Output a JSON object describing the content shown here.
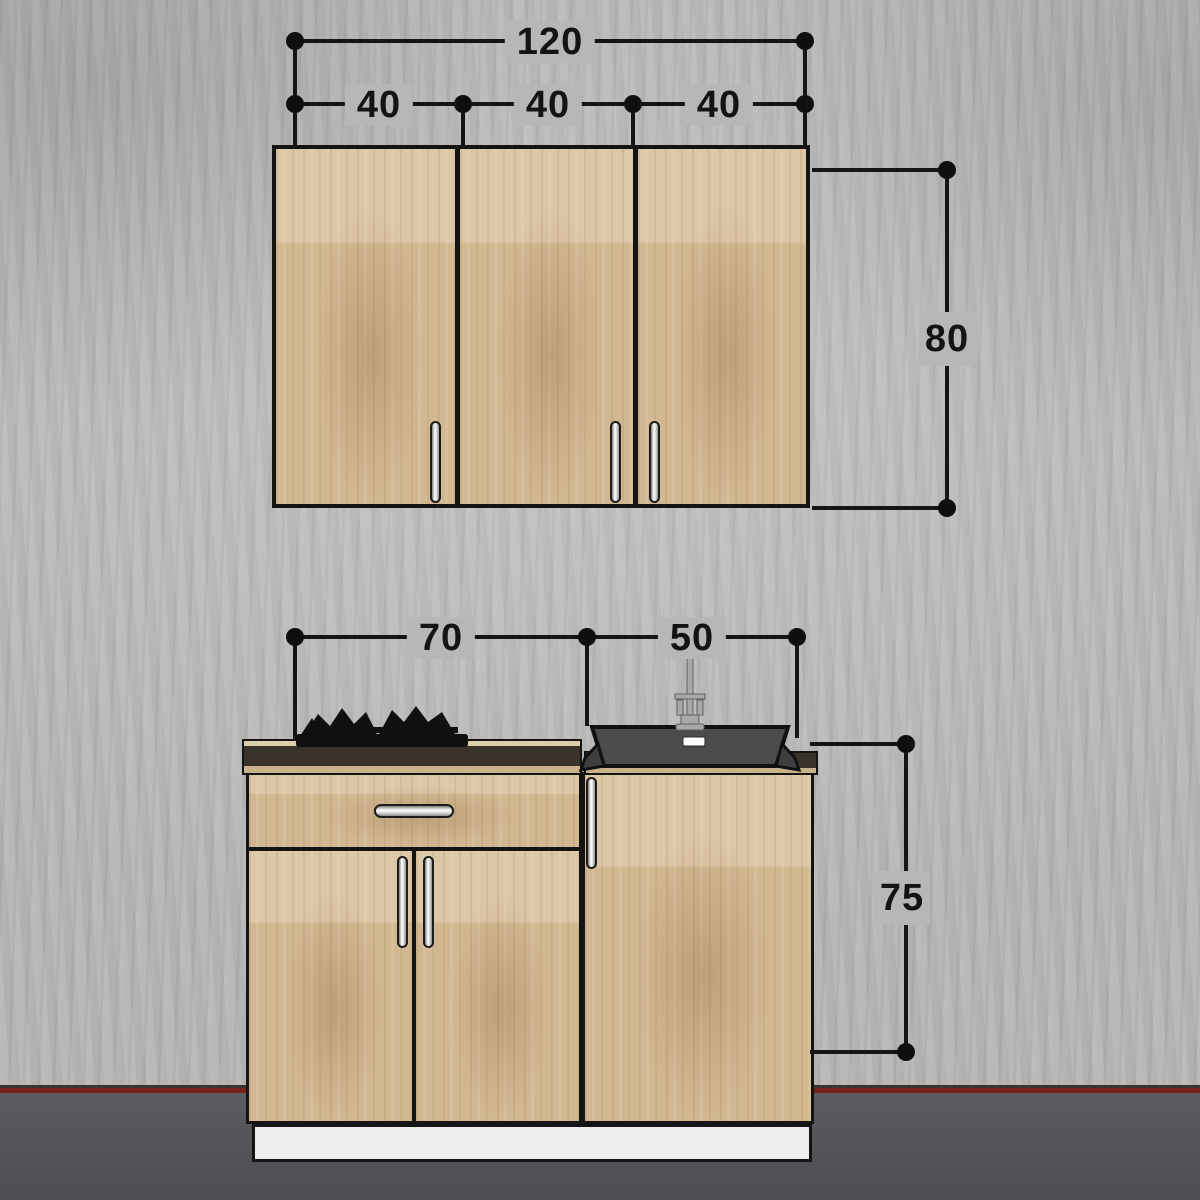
{
  "dimensions": {
    "overall_width": "120",
    "door_widths": [
      "40",
      "40",
      "40"
    ],
    "wall_cabinet_height": "80",
    "cooktop_unit_width": "70",
    "sink_unit_width": "50",
    "base_unit_height": "75"
  },
  "colors": {
    "wall": "#b6b5b3",
    "floor": "#525356",
    "baseboard_red": "#7a211a",
    "wood": "#d6bd97",
    "outline": "#141414",
    "counter_dark": "#3a332b",
    "sink_gray": "#4c4c4e",
    "plinth_white": "#ecedec",
    "handle_chrome": "#fbfbfa"
  }
}
